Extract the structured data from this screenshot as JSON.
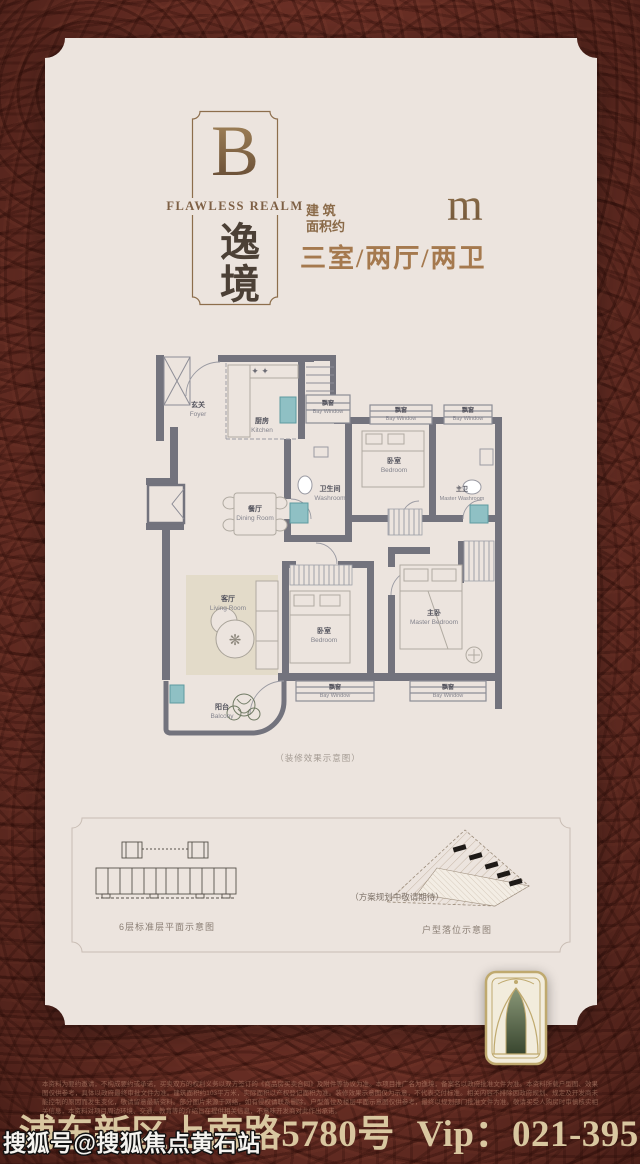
{
  "page": {
    "bg_color": "#76352a",
    "card_color": "#ece4de",
    "accent_bronze": "#8a6a48"
  },
  "header": {
    "logo_letter": "B",
    "logo_subtitle": "FLAWLESS REALM",
    "logo_name": "逸境",
    "area_label_line1": "建 筑",
    "area_label_line2": "面积约",
    "area_value": "103",
    "area_unit": "m",
    "area_exponent": "2",
    "unit_layout": "三室/两厅/两卫"
  },
  "plan": {
    "caption": "（装修效果示意图）",
    "rooms": {
      "foyer": {
        "zh": "玄关",
        "en": "Foyer"
      },
      "kitchen": {
        "zh": "厨房",
        "en": "Kitchen"
      },
      "dining": {
        "zh": "餐厅",
        "en": "Dining Room"
      },
      "washroom": {
        "zh": "卫生间",
        "en": "Washroom"
      },
      "bedroom": {
        "zh": "卧室",
        "en": "Bedroom"
      },
      "master_washroom": {
        "zh": "主卫",
        "en": "Master Washroom"
      },
      "living": {
        "zh": "客厅",
        "en": "Living Room"
      },
      "master_bedroom": {
        "zh": "主卧",
        "en": "Master Bedroom"
      },
      "balcony": {
        "zh": "阳台",
        "en": "Balcony"
      },
      "bay": {
        "zh": "飘窗",
        "en": "Bay Window"
      }
    }
  },
  "bottom": {
    "left_caption": "6层标准层平面示意图",
    "right_note": "（方案规划中敬请期待）",
    "right_caption": "户型落位示意图"
  },
  "footer": {
    "fine_print": "本资料为要约邀请，不构成要约或承诺，买卖双方的权利义务以双方签订的《商品房买卖合同》及附件等协议为准。本项目推广名为逸境，备案名以政府批准文件为准。本资料所载户型图、效果图仅供参考，具体以政府最终审批文件为准。建筑面积约103平方米，实际面积以产权登记面积为准。装修效果示意图仅为示意，不代表交付标准。相关内容不排除因政府规划、规定及开发商未能控制的原因而发生变化，敬请留意最新资料。部分图片来源于网络，如有侵权请联系删除。户型落位及楼层平面示意图仅供参考，最终以规划部门批准文件为准。敬请买受人购房时审慎核实相关信息，本资料对项目周边环境、交通、教育等的介绍旨在提供相关信息，不意味开发商对此作出承诺。",
    "address": "地址：浦东新区上南路5780号",
    "vip": "Vip：021-39527365",
    "watermark": "搜狐号@搜狐焦点黄石站"
  }
}
